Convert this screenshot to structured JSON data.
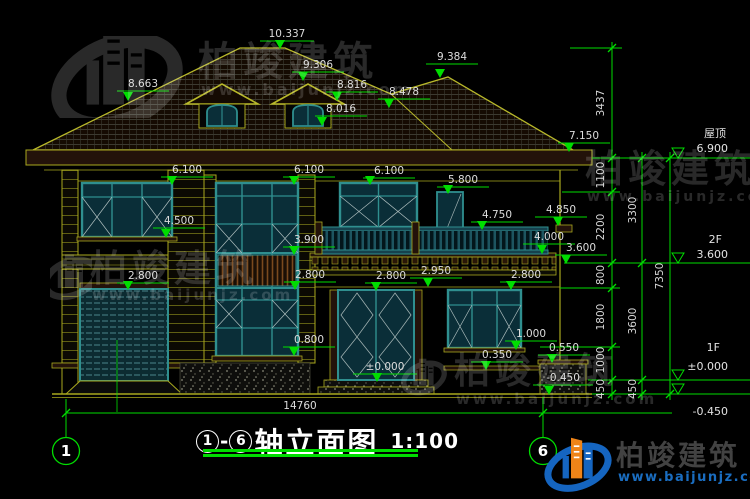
{
  "watermark": {
    "brand": "柏竣建筑",
    "url": "www.baijunjz.com"
  },
  "logo": {
    "brand": "柏竣建筑",
    "url": "www.baijunjz.com"
  },
  "title": {
    "axis_start": "1",
    "dash": "-",
    "axis_end": "6",
    "name": "轴立面图",
    "scale": "1:100"
  },
  "axes": {
    "left": "1",
    "right": "6"
  },
  "levels": {
    "roof": {
      "label": "屋顶",
      "value": "6.900"
    },
    "f2": {
      "label": "2F",
      "value": "3.600"
    },
    "f1": {
      "label": "1F",
      "value": "±0.000"
    },
    "ground": {
      "value": "-0.450"
    }
  },
  "chains": {
    "inner": [
      "3437",
      "1100",
      "2200",
      "800",
      "1800",
      "1000",
      "450"
    ],
    "middle": [
      "3300",
      "3600",
      "450"
    ],
    "outer": [
      "7350"
    ],
    "width": "14760"
  },
  "spots": {
    "ridge_main": "10.337",
    "ridge_right": "9.384",
    "dormer_ridge": "9.306",
    "slope_left": "8.663",
    "dormer_eave": "8.816",
    "valley": "8.478",
    "dormer_base": "8.016",
    "eave_right": "7.150",
    "head_2f_left": "6.100",
    "head_2f_mid": "6.100",
    "head_2f_right": "6.100",
    "door_2f_head": "5.800",
    "ledge_right": "4.850",
    "railing_top": "4.750",
    "sill_2f_left": "4.500",
    "balcony_soffit": "4.000",
    "stair_win_rail": "3.900",
    "slab_right": "3.600",
    "slab_top": "2.950",
    "garage_head": "2.800",
    "stair_win_mid": "2.800",
    "door_1f_head": "2.800",
    "win_1f_head": "2.800",
    "win_1f_sill": "1.000",
    "stair_win_sill": "0.800",
    "plinth_right": "0.550",
    "porch_ledge": "0.350",
    "threshold": "±0.000",
    "ground_line": "-0.450"
  }
}
